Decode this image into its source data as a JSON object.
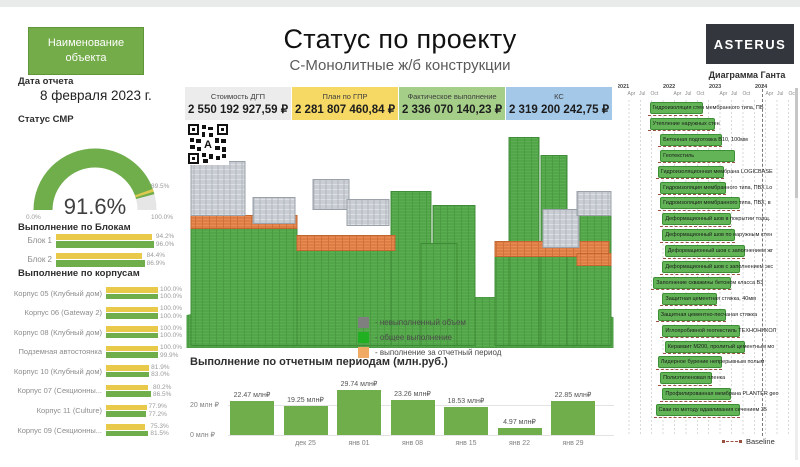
{
  "colors": {
    "accent_green": "#74ac49",
    "bar_yellow": "#e9c94a",
    "bar_green": "#6fae4b",
    "gantt_bar": "#63b457",
    "baseline": "#9a5040",
    "logo_bg": "#33373d"
  },
  "header": {
    "object_button_label": "Наименование объекта",
    "title": "Статус по проекту",
    "subtitle": "С-Монолитные ж/б конструкции",
    "logo_text": "ASTERUS"
  },
  "report": {
    "date_label": "Дата отчета",
    "date_value": "8 февраля 2023 г."
  },
  "gauge": {
    "title": "Статус СМР",
    "value": 91.6,
    "value_label": "91.6%",
    "min_label": "0.0%",
    "max_label": "100.0%",
    "target": 89.5,
    "target_label": "89.5%"
  },
  "kpis": [
    {
      "label": "Стоимость ДГП",
      "value": "2 550 192 927,59 ₽",
      "bg": "#ececec"
    },
    {
      "label": "План по ГПР",
      "value": "2 281 807 460,84 ₽",
      "bg": "#f6d964"
    },
    {
      "label": "Фактическое выполнение",
      "value": "2 336 070 140,23 ₽",
      "bg": "#a5cf88"
    },
    {
      "label": "КС",
      "value": "2 319 200 242,75 ₽",
      "bg": "#a3c8e8"
    }
  ],
  "building": {
    "qr_overlay_letter": "A",
    "legend": [
      {
        "color": "#7f7f7f",
        "label": "- невыполненный объем"
      },
      {
        "color": "#21b021",
        "label": "- общее выполнение"
      },
      {
        "color": "#f0aa64",
        "label": "- выполнение за отчетный период"
      }
    ]
  },
  "chart_data": [
    {
      "type": "bar",
      "title": "Выполнение по отчетным периодам (млн.руб.)",
      "values": [
        22.47,
        19.25,
        29.74,
        23.26,
        18.53,
        4.97,
        22.85
      ],
      "value_labels": [
        "22.47 млн₽",
        "19.25 млн₽",
        "29.74 млн₽",
        "23.26 млн₽",
        "18.53 млн₽",
        "4.97 млн₽",
        "22.85 млн₽"
      ],
      "x_labels": [
        "",
        "дек 25",
        "янв 01",
        "янв 08",
        "янв 15",
        "янв 22",
        "янв 29"
      ],
      "y_max_label": "20 млн ₽",
      "y_min_label": "0 млн ₽",
      "ylim": [
        0,
        30
      ],
      "gridline_at": 20
    },
    {
      "type": "bar",
      "title": "Выполнение по Блокам",
      "categories": [
        "Блок 1",
        "Блок 2"
      ],
      "series": [
        {
          "color": "#e9c94a",
          "values": [
            94.2,
            84.4
          ],
          "labels": [
            "94.2%",
            "84.4%"
          ]
        },
        {
          "color": "#6fae4b",
          "values": [
            96.0,
            86.9
          ],
          "labels": [
            "96.0%",
            "86.9%"
          ]
        }
      ],
      "xlim": [
        0,
        100
      ]
    },
    {
      "type": "bar",
      "title": "Выполнение по корпусам",
      "categories": [
        "Корпус 05 (Клубный дом)",
        "Корпус 06 (Gateway 2)",
        "Корпус 08 (Клубный дом)",
        "Подземная автостоянка",
        "Корпус 10 (Клубный дом)",
        "Корпус 07 (Секционны...",
        "Корпус 11 (Culture)",
        "Корпус 09 (Секционны..."
      ],
      "series": [
        {
          "color": "#e9c94a",
          "values": [
            100.0,
            100.0,
            100.0,
            100.0,
            81.9,
            80.2,
            77.9,
            75.3
          ],
          "labels": [
            "100.0%",
            "100.0%",
            "100.0%",
            "100.0%",
            "81.9%",
            "80.2%",
            "77.9%",
            "75.3%"
          ]
        },
        {
          "color": "#6fae4b",
          "values": [
            100.0,
            100.0,
            100.0,
            99.9,
            83.0,
            86.5,
            77.2,
            81.5
          ],
          "labels": [
            "100.0%",
            "100.0%",
            "100.0%",
            "99.9%",
            "83.0%",
            "86.5%",
            "77.2%",
            "81.5%"
          ]
        }
      ],
      "xlim": [
        0,
        100
      ]
    }
  ],
  "gantt": {
    "title": "Диаграмма Ганта",
    "years": [
      "2021",
      "2022",
      "2023",
      "2024"
    ],
    "minor_ticks": [
      "Apr",
      "Jul",
      "Oct"
    ],
    "baseline_label": "Baseline",
    "tasks": [
      {
        "name": "Гидроизоляция стен мембранного типа, ПВ",
        "start": 2021.62,
        "end": 2022.7
      },
      {
        "name": "Утепление наружных стен",
        "start": 2021.62,
        "end": 2022.95
      },
      {
        "name": "Бетонная подготовка В10, 100мм",
        "start": 2021.85,
        "end": 2023.1
      },
      {
        "name": "Геотекстиль",
        "start": 2021.85,
        "end": 2023.4
      },
      {
        "name": "Гидроизоляционная мембрана LOGICBASE",
        "start": 2021.8,
        "end": 2023.15
      },
      {
        "name": "Гидроизоляция мембранного типа, ПВХ Lo",
        "start": 2021.85,
        "end": 2023.2
      },
      {
        "name": "Гидроизоляция мембранного типа, ПВХ, в",
        "start": 2021.85,
        "end": 2023.5
      },
      {
        "name": "Деформационный шов в покрытии толщ.",
        "start": 2021.9,
        "end": 2023.3
      },
      {
        "name": "Деформационный шов по наружным стен",
        "start": 2021.9,
        "end": 2023.4
      },
      {
        "name": "Деформационный шов с заполнением жг",
        "start": 2021.95,
        "end": 2023.6
      },
      {
        "name": "Деформационный шов с заполнением экс",
        "start": 2021.9,
        "end": 2023.5
      },
      {
        "name": "Заполнение скважины бетоном класса В3",
        "start": 2021.7,
        "end": 2023.3
      },
      {
        "name": "Защитная цементная стяжка, 40мм",
        "start": 2021.9,
        "end": 2023.0
      },
      {
        "name": "Защитная цементно-песчаная стяжка",
        "start": 2021.8,
        "end": 2023.2
      },
      {
        "name": "Иглопробивной геотекстиль ТЕХНОНИКОЛ",
        "start": 2021.9,
        "end": 2023.5
      },
      {
        "name": "Керамзит М200, пролитый цементным мо",
        "start": 2021.95,
        "end": 2023.6
      },
      {
        "name": "Лидерное бурение непрерывным полым",
        "start": 2021.8,
        "end": 2023.1
      },
      {
        "name": "Полиэтиленовая пленка",
        "start": 2021.85,
        "end": 2022.9
      },
      {
        "name": "Профилированная мембрана PLANTER geo",
        "start": 2021.9,
        "end": 2023.3
      },
      {
        "name": "Сваи по методу вдавливания сечением 35",
        "start": 2021.75,
        "end": 2023.5
      }
    ]
  }
}
